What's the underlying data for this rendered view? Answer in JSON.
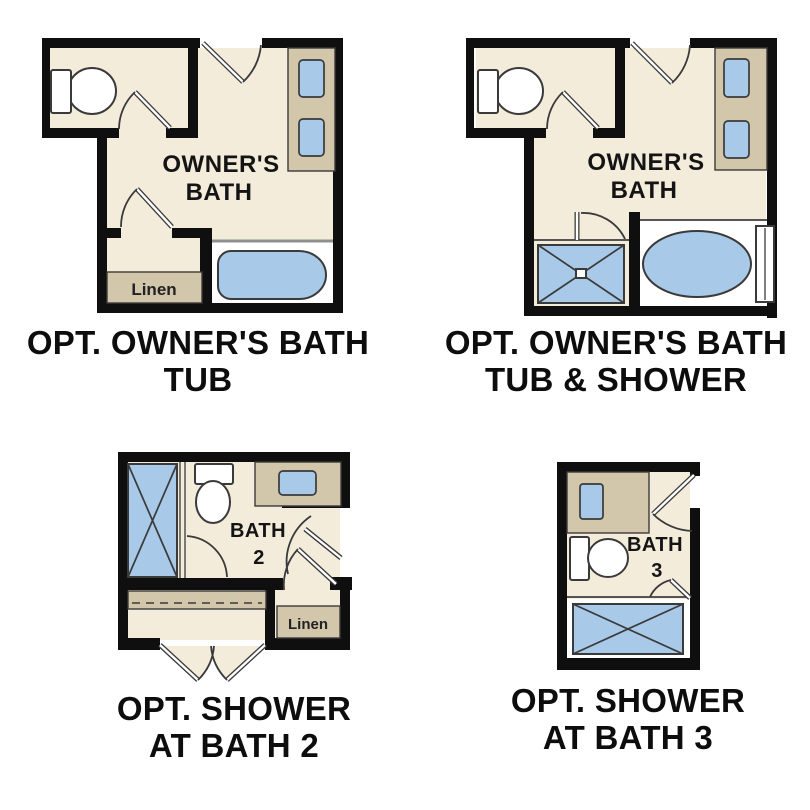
{
  "colors": {
    "bg": "#ffffff",
    "wall": "#0f0f0f",
    "floor": "#f3ecdb",
    "counter": "#d2c6ab",
    "fixture": "#a9c9e8",
    "line": "#3a3a3a",
    "deck": "#ffffff",
    "deck_edge": "#8f8f8f",
    "label": "#141414",
    "caption": "#0d0d0d"
  },
  "plans": {
    "owners_tub": {
      "room_label": [
        "OWNER'S",
        "BATH"
      ],
      "linen_label": "Linen",
      "caption": [
        "OPT. OWNER'S BATH",
        "TUB"
      ]
    },
    "owners_tub_shower": {
      "room_label": [
        "OWNER'S",
        "BATH"
      ],
      "caption": [
        "OPT. OWNER'S BATH",
        "TUB & SHOWER"
      ]
    },
    "bath2": {
      "room_label": [
        "BATH",
        "2"
      ],
      "linen_label": "Linen",
      "caption": [
        "OPT. SHOWER",
        "AT BATH 2"
      ]
    },
    "bath3": {
      "room_label": [
        "BATH",
        "3"
      ],
      "caption": [
        "OPT. SHOWER",
        "AT BATH 3"
      ]
    }
  }
}
